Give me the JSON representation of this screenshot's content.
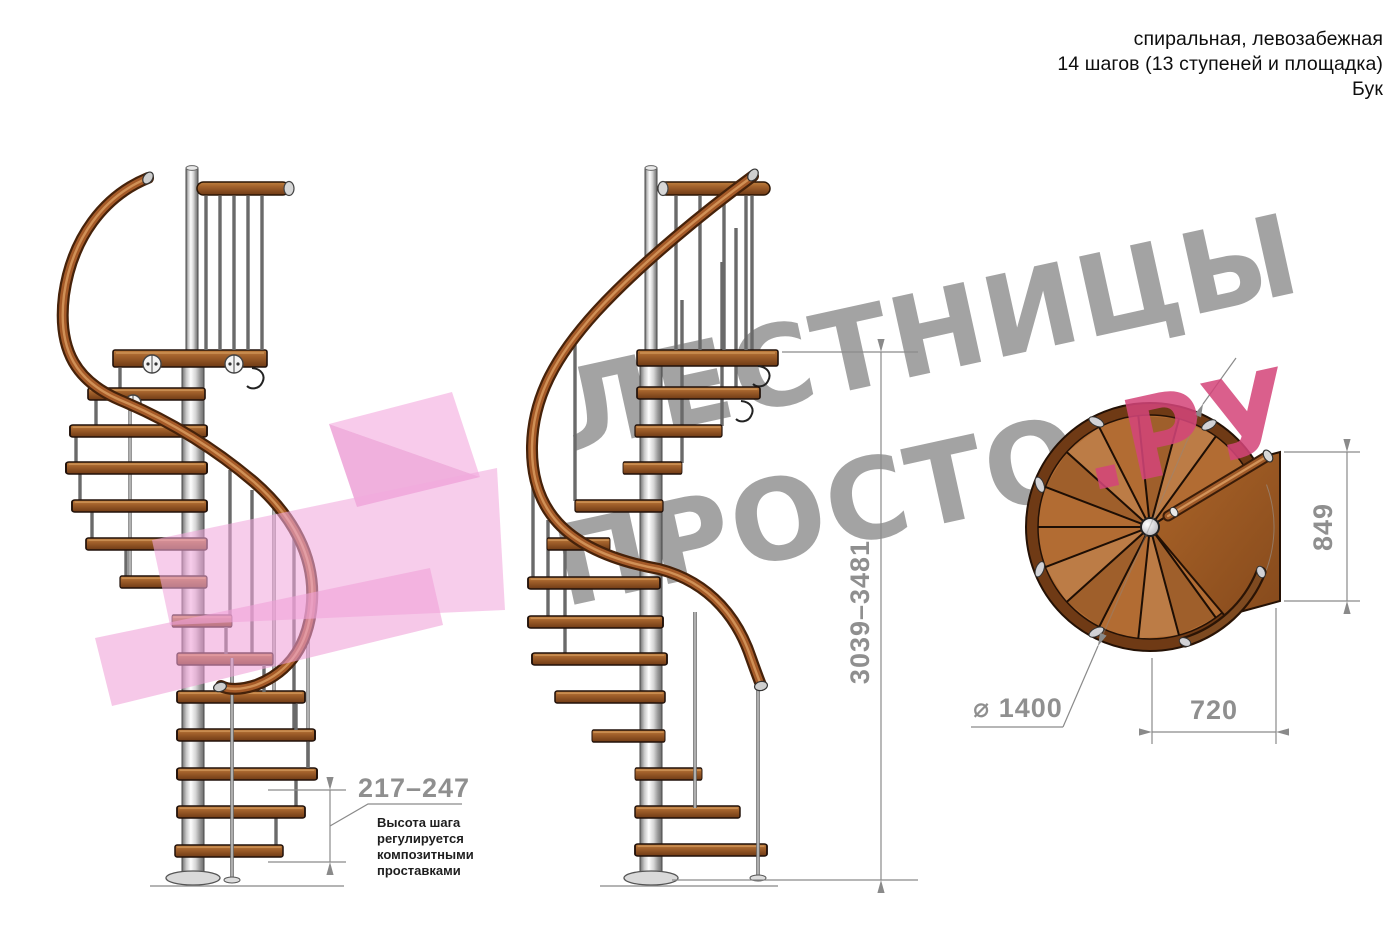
{
  "header": {
    "line1": "спиральная, левозабежная",
    "line2": "14 шагов (13 ступеней и площадка)",
    "line3": "Бук"
  },
  "watermark": {
    "line1": "ЛЕСТНИЦЫ",
    "line2_gray": "ПРОСТО",
    "line2_accent": ".РУ"
  },
  "dimensions": {
    "step_height": "217–247",
    "step_note_lines": [
      "Высота шага",
      "регулируется",
      "композитными",
      "проставками"
    ],
    "total_height": "3039–3481",
    "landing_depth": "849",
    "landing_width": "720",
    "diameter": "⌀ 1400"
  },
  "colors": {
    "wood": "#a3622c",
    "wood_dark": "#6f3a15",
    "pole_metal": "#c7c7c7",
    "dimension_gray": "#8f8f8f",
    "watermark_gray": "#9d9d9d",
    "accent_pink": "#d4457a",
    "shape_pink": "#f2a9dc"
  }
}
